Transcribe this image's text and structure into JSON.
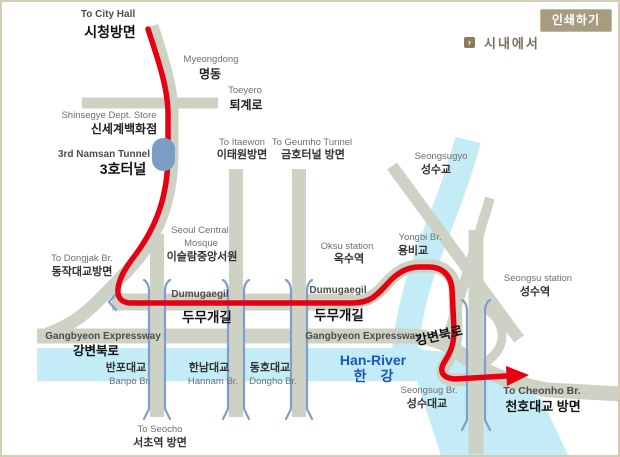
{
  "header": {
    "print_button": "인쇄하기",
    "section_title": "시내에서",
    "section_icon": "arrow-bullet"
  },
  "colors": {
    "frame": "#d6ccb4",
    "road": "#cdd2c5",
    "river": "#c3ecf7",
    "route": "#e60012",
    "tunnel": "#7b9dc4",
    "bridge": "#7e9fce",
    "han_text": "#1b54c0",
    "button_bg": "#a89c80",
    "button_text": "#ffffff",
    "icon_bg": "#8d7a5c",
    "section_text": "#7b6e55"
  },
  "labels": {
    "city_hall": {
      "en": "To City Hall",
      "ko": "시청방면"
    },
    "myeongdong": {
      "en": "Myeongdong",
      "ko": "명동"
    },
    "toeyero": {
      "en": "Toeyero",
      "ko": "퇴계로"
    },
    "shinsegye": {
      "en": "Shinsegye Dept. Store",
      "ko": "신세계백화점"
    },
    "namsan_tunnel": {
      "en": "3rd Namsan Tunnel",
      "ko": "3호터널"
    },
    "itaewon": {
      "en": "To Itaewon",
      "ko": "이태원방면"
    },
    "geumho": {
      "en": "To Geumho Tunnel",
      "ko": "금호터널 방면"
    },
    "seongsugyo": {
      "en": "Seongsugyo",
      "ko": "성수교"
    },
    "mosque": {
      "en": "Seoul Central",
      "en2": "Mosque",
      "ko": "이슬람중앙서원"
    },
    "dongjak": {
      "en": "To Dongjak Br.",
      "ko": "동작대교방면"
    },
    "oksu": {
      "en": "Oksu station",
      "ko": "옥수역"
    },
    "yongbi": {
      "en": "Yongbi Br.",
      "ko": "용비교"
    },
    "seongsu_station": {
      "en": "Seongsu station",
      "ko": "성수역"
    },
    "dumugaegil_left": {
      "en": "Dumugaegil",
      "ko": "두무개길"
    },
    "dumugaegil_right": {
      "en": "Dumugaegil",
      "ko": "두무개길"
    },
    "gangbyeon_left": {
      "en": "Gangbyeon Expressway",
      "ko": "강변북로"
    },
    "gangbyeon_right": {
      "en": "Gangbyeon Expressway",
      "ko": "강변북로"
    },
    "han_river": {
      "en": "Han-River",
      "ko": "한 강"
    },
    "banpo": {
      "ko": "반포대교",
      "en": "Banpo Br."
    },
    "hannam": {
      "ko": "한남대교",
      "en": "Hannam Br."
    },
    "dongho": {
      "ko": "동호대교",
      "en": "Dongho Br."
    },
    "seocho": {
      "en": "To Seocho",
      "ko": "서초역 방면"
    },
    "seongsu_br": {
      "en": "Seongsug Br.",
      "ko": "성수대교"
    },
    "cheonho": {
      "en": "To Cheonho Br.",
      "ko": "천호대교 방면"
    }
  }
}
